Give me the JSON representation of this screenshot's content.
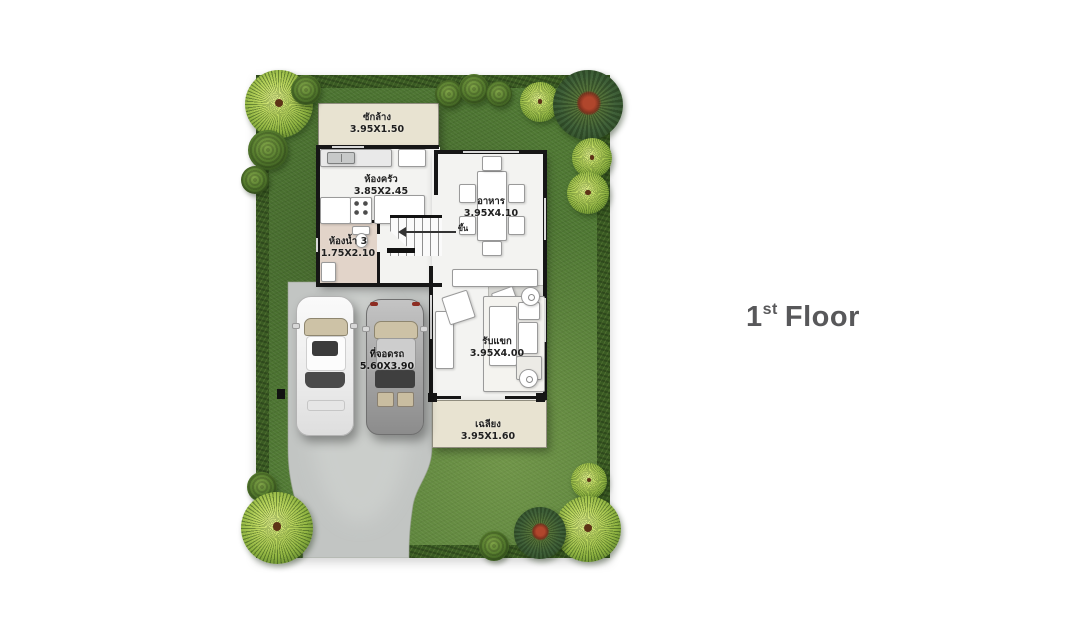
{
  "title": {
    "number": "1",
    "suffix": "st",
    "word": "Floor"
  },
  "rooms": {
    "laundry": {
      "name": "ซักล้าง",
      "size": "3.95X1.50"
    },
    "kitchen": {
      "name": "ห้องครัว",
      "size": "3.85X2.45"
    },
    "bathroom": {
      "name": "ห้องน้ำ 3",
      "size": "1.75X2.10"
    },
    "dining": {
      "name": "อาหาร",
      "size": "3.95X4.10"
    },
    "living": {
      "name": "รับแขก",
      "size": "3.95X4.00"
    },
    "porch": {
      "name": "เฉลียง",
      "size": "3.95X1.60"
    },
    "carport": {
      "name": "ที่จอดรถ",
      "size": "5.60X3.90"
    },
    "stairs": {
      "label": "ขึ้น"
    }
  },
  "objects": {
    "cars": [
      {
        "color": "white"
      },
      {
        "color": "gray"
      }
    ]
  },
  "colors": {
    "lawn": "#4f7833",
    "hedge": "#3a5b23",
    "concrete": "#c2c5c3",
    "floor": "#f3f3f1",
    "beige": "#e8e3d1",
    "bath_floor": "#e2d4c9",
    "wall": "#161616",
    "title_text": "#58585a"
  }
}
